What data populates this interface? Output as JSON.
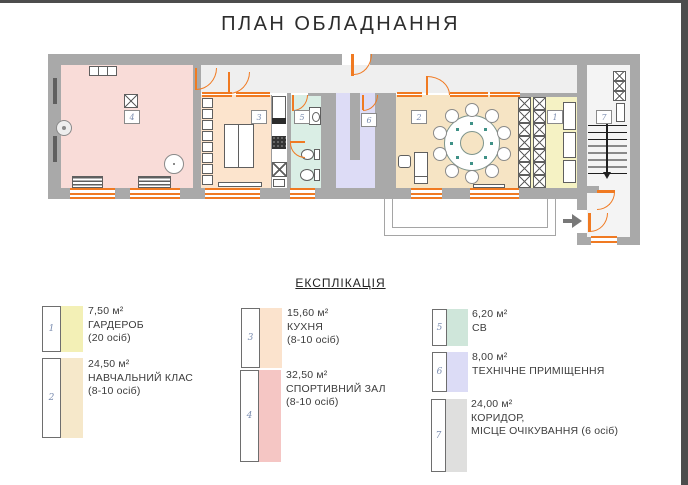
{
  "title": "ПЛАН ОБЛАДНАННЯ",
  "legend": {
    "heading": "ЕКСПЛІКАЦІЯ",
    "items": [
      {
        "number": "1",
        "area": "7,50 м²",
        "line1": "ГАРДЕРОБ",
        "line2": "(20 осіб)",
        "color": "#f3f0b6"
      },
      {
        "number": "2",
        "area": "24,50 м²",
        "line1": "НАВЧАЛЬНИЙ КЛАС",
        "line2": "(8-10 осіб)",
        "color": "#f6e8ca"
      },
      {
        "number": "3",
        "area": "15,60 м²",
        "line1": "КУХНЯ",
        "line2": "(8-10 осіб)",
        "color": "#fbe3cd"
      },
      {
        "number": "4",
        "area": "32,50 м²",
        "line1": "СПОРТИВНИЙ ЗАЛ",
        "line2": "(8-10 осіб)",
        "color": "#f5c6c4"
      },
      {
        "number": "5",
        "area": "6,20 м²",
        "line1": "СВ",
        "line2": "",
        "color": "#cfe6da"
      },
      {
        "number": "6",
        "area": "8,00 м²",
        "line1": "ТЕХНІЧНЕ ПРИМІЩЕННЯ",
        "line2": "",
        "color": "#dcdcf6"
      },
      {
        "number": "7",
        "area": "24,00 м²",
        "line1": "КОРИДОР,",
        "line2": "МІСЦЕ ОЧІКУВАННЯ (6 осіб)",
        "color": "#dfdfde"
      }
    ]
  },
  "colors": {
    "vars": {
      "wall": "#a9a9a9",
      "door": "#f07a22",
      "furn": "#5f5f5f",
      "stair": "#1f1f1f",
      "num": "#7b8db0",
      "teal": "#3f9187"
    },
    "rooms": {
      "r1": "#f5f2c4",
      "r2": "#f6e4c4",
      "r3": "#fce4cd",
      "r4": "#f9dcd8",
      "r5": "#daeee5",
      "r6": "#dddcf6",
      "corridor": "#efefef",
      "wing": "#f4f4f4",
      "counter_strip": "#ffffff"
    }
  }
}
